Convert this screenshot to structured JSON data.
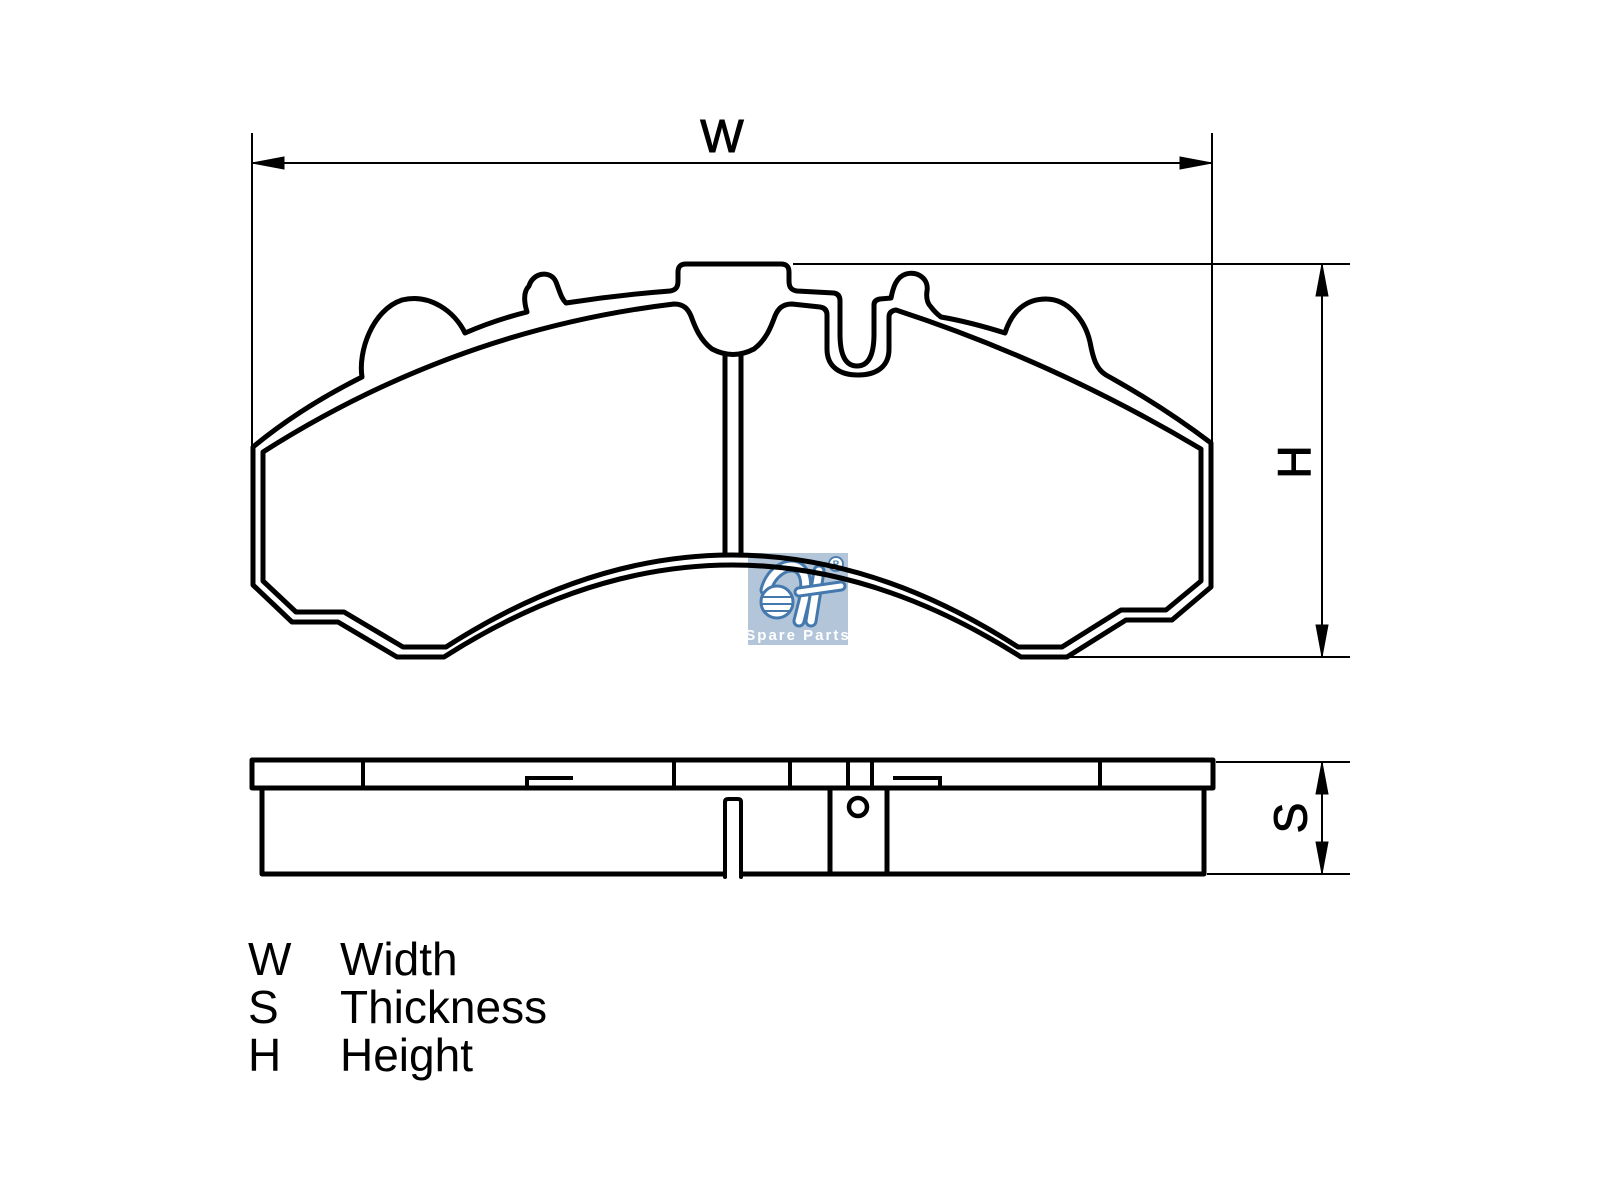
{
  "colors": {
    "background": "#ffffff",
    "line": "#000000"
  },
  "dimensions": {
    "width": "W",
    "height": "H",
    "thickness": "S"
  },
  "legend": {
    "rows": [
      {
        "symbol": "W",
        "label": "Width"
      },
      {
        "symbol": "S",
        "label": "Thickness"
      },
      {
        "symbol": "H",
        "label": "Height"
      }
    ]
  },
  "watermark": {
    "brand": "DT",
    "registered": "R",
    "subtitle": "Spare Parts",
    "box_color": "#b2c5d9",
    "logo_color": "#4579ad",
    "text_color": "#ffffff"
  }
}
